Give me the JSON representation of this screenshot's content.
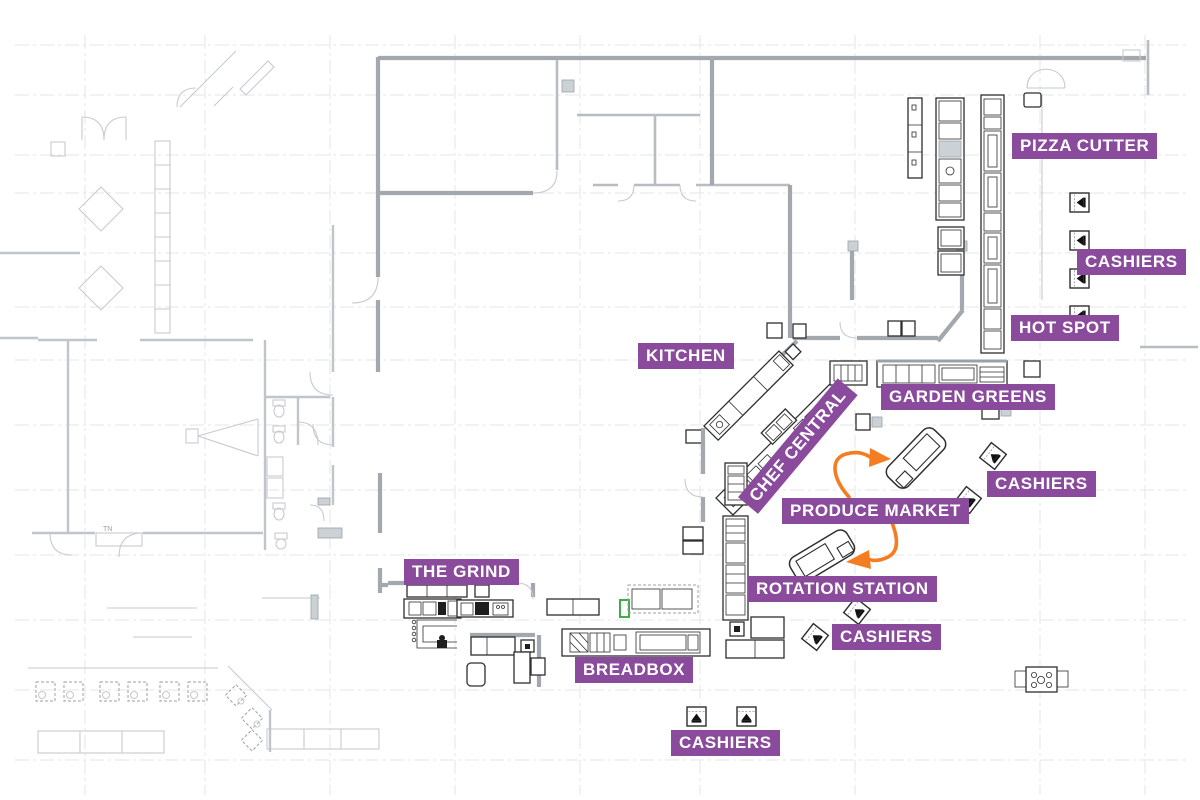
{
  "page": {
    "type": "dining-hall-floor-plan",
    "background": "#ffffff"
  },
  "palette": {
    "label_bg": "#8a4b9c",
    "label_text": "#ffffff",
    "arrow_orange": "#f47d21",
    "wall_gray": "#a2a8ae",
    "light_line_gray": "#c6cbd0",
    "grid_gray": "#e4e6e8",
    "equipment_dark": "#2e2e2e",
    "highlight_green": "#3fae49"
  },
  "stations": {
    "pizza_cutter": "PIZZA CUTTER",
    "cashiers_right": "CASHIERS",
    "hot_spot": "HOT SPOT",
    "garden_greens": "GARDEN GREENS",
    "kitchen": "KITCHEN",
    "chef_central": "CHEF CENTRAL",
    "produce_market": "PRODUCE MARKET",
    "cashiers_produce": "CASHIERS",
    "rotation_station": "ROTATION STATION",
    "cashiers_rotation": "CASHIERS",
    "the_grind": "THE GRIND",
    "breadbox": "BREADBOX",
    "cashiers_south": "CASHIERS"
  },
  "cashier_stands": {
    "right_column_count": 4,
    "produce_market_count": 2,
    "rotation_station_count": 2,
    "south_count": 2
  },
  "flow_arrows": {
    "count": 2,
    "color": "#f47d21",
    "meaning": "circulation around produce market cases"
  },
  "plan_annotations": {
    "tn_note": "TN"
  }
}
